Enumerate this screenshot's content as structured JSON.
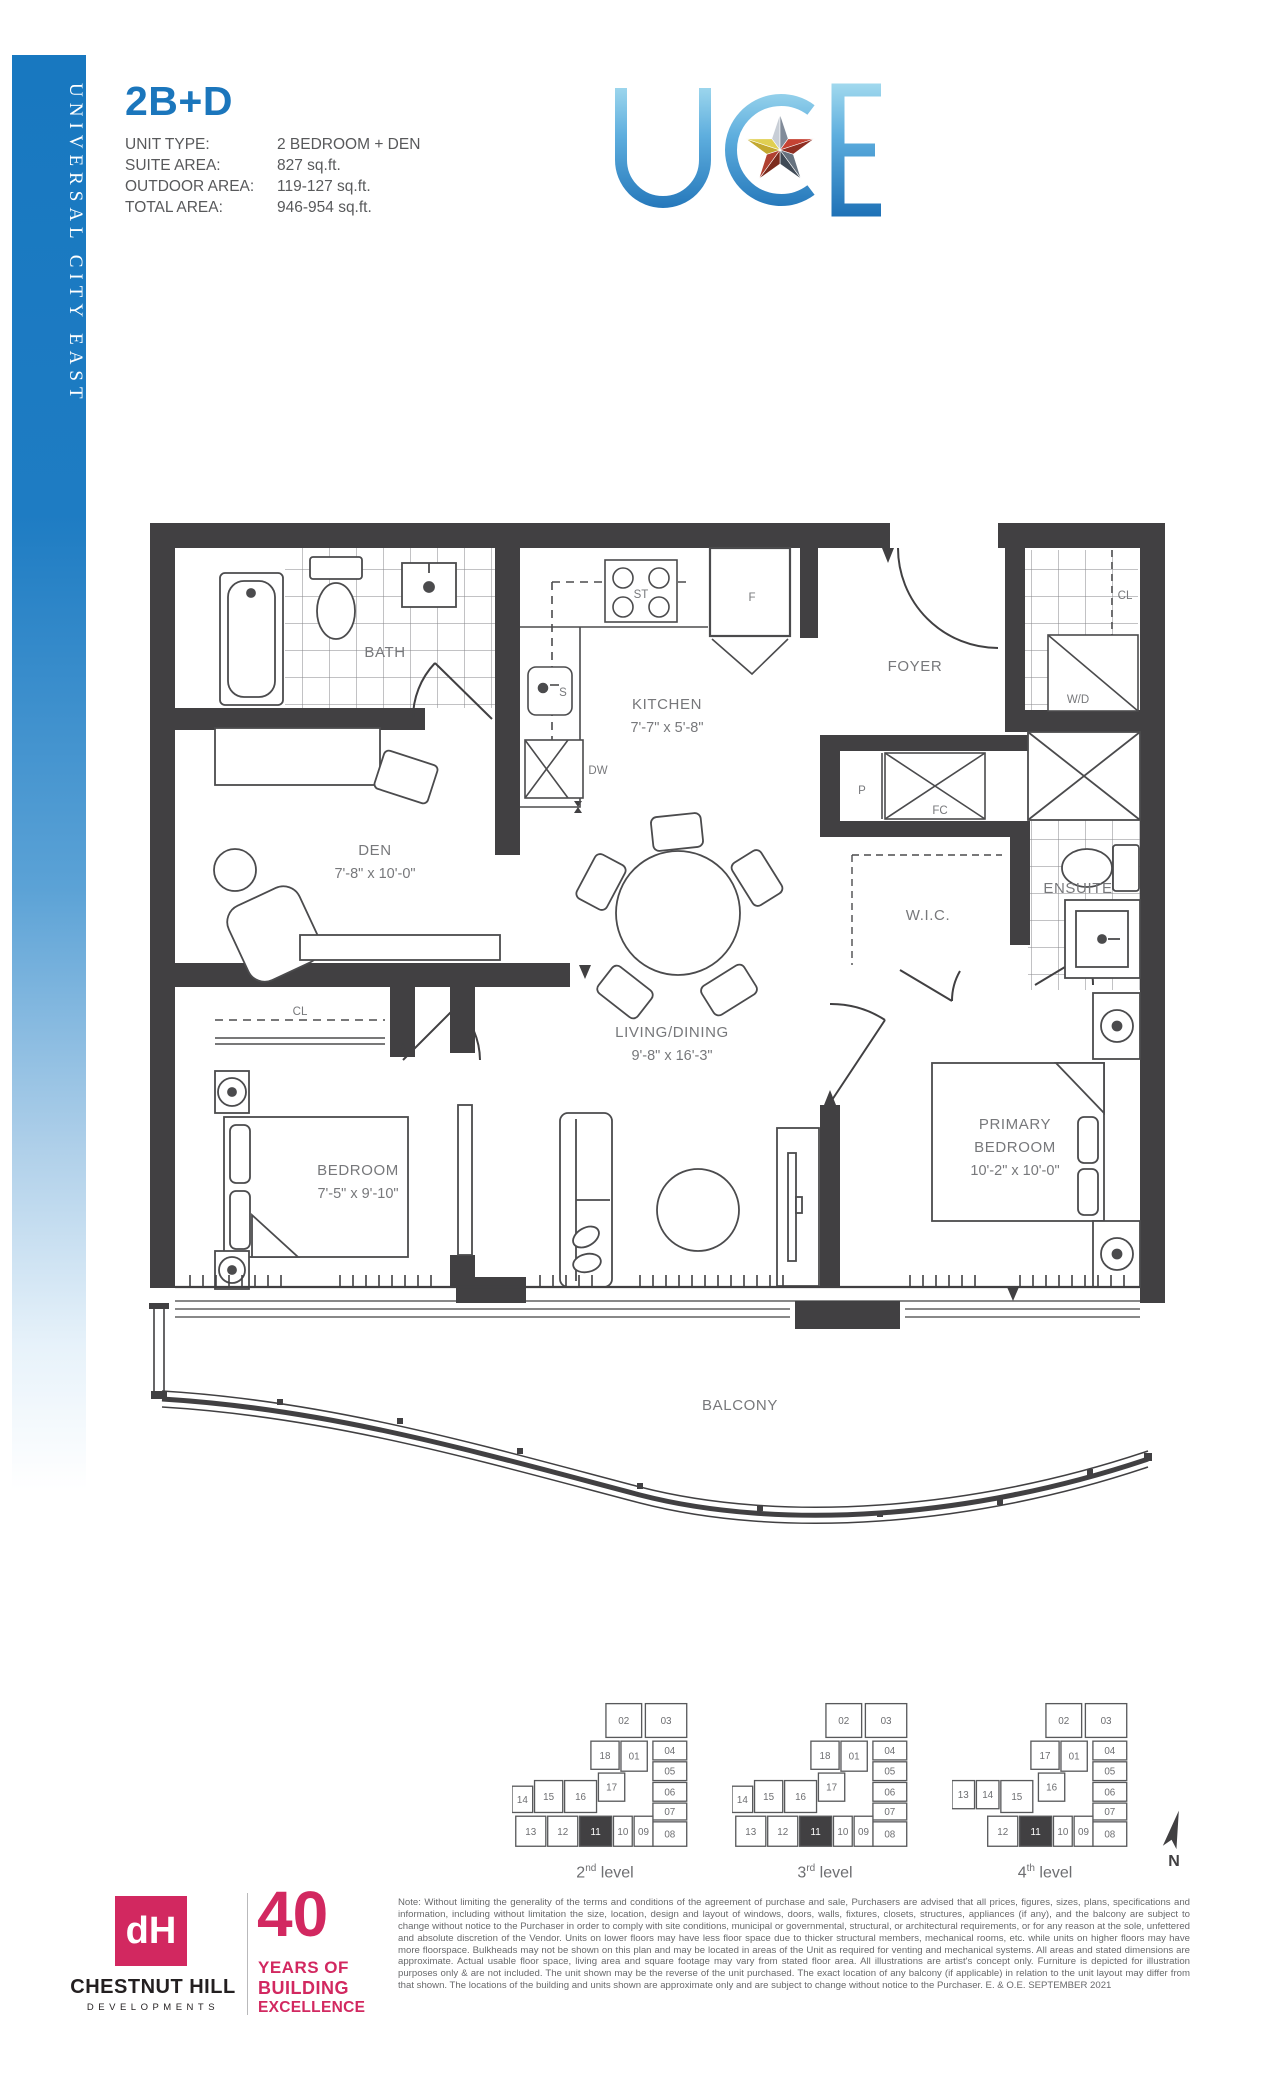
{
  "page_title": "2B+D Floor Plan",
  "sidebar": {
    "text": "UNIVERSAL CITY EAST"
  },
  "header": {
    "plan_code": "2B+D",
    "specs": [
      {
        "label": "UNIT TYPE:",
        "value": "2 BEDROOM + DEN"
      },
      {
        "label": "SUITE AREA:",
        "value": "827 sq.ft."
      },
      {
        "label": "OUTDOOR AREA:",
        "value": "119-127 sq.ft."
      },
      {
        "label": "TOTAL AREA:",
        "value": "946-954 sq.ft."
      }
    ]
  },
  "logo": {
    "name": "UCE",
    "blue_top": "#a6dcef",
    "blue_bottom": "#1c6fb5"
  },
  "colors": {
    "accent_blue": "#1b76bc",
    "brand_pink": "#d22860",
    "wall": "#414042",
    "label_gray": "#77787b"
  },
  "floorplan": {
    "bath": "BATH",
    "kitchen": "KITCHEN",
    "kitchen_dims": "7'-7\" x 5'-8\"",
    "foyer": "FOYER",
    "den": "DEN",
    "den_dims": "7'-8\" x 10'-0\"",
    "wic": "W.I.C.",
    "ensuite": "ENSUITE",
    "living": "LIVING/DINING",
    "living_dims": "9'-8\" x 16'-3\"",
    "bedroom": "BEDROOM",
    "bedroom_dims": "7'-5\" x 9'-10\"",
    "primary1": "PRIMARY",
    "primary2": "BEDROOM",
    "primary_dims": "10'-2\" x 10'-0\"",
    "balcony": "BALCONY",
    "cl_foyer": "CL",
    "cl_bedroom": "CL",
    "wd": "W/D",
    "st": "ST",
    "f": "F",
    "s": "S",
    "dw": "DW",
    "p": "P",
    "fc": "FC"
  },
  "keyplans": {
    "levels": [
      {
        "num": "2",
        "suffix": "nd",
        "word": "level",
        "cells": [
          [
            "02",
            100,
            6,
            38,
            36,
            0
          ],
          [
            "03",
            142,
            6,
            44,
            36,
            0
          ],
          [
            "04",
            150,
            46,
            36,
            20,
            0
          ],
          [
            "05",
            150,
            68,
            36,
            20,
            0
          ],
          [
            "06",
            150,
            90,
            36,
            20,
            0
          ],
          [
            "07",
            150,
            112,
            36,
            18,
            0
          ],
          [
            "08",
            150,
            132,
            36,
            26,
            0
          ],
          [
            "01",
            116,
            46,
            28,
            32,
            0
          ],
          [
            "18",
            84,
            46,
            30,
            30,
            0
          ],
          [
            "17",
            92,
            80,
            28,
            30,
            0
          ],
          [
            "16",
            56,
            88,
            34,
            34,
            0
          ],
          [
            "15",
            24,
            88,
            30,
            34,
            0
          ],
          [
            "14",
            0,
            94,
            22,
            28,
            0
          ],
          [
            "13",
            4,
            126,
            32,
            32,
            0
          ],
          [
            "12",
            38,
            126,
            32,
            32,
            0
          ],
          [
            "11",
            72,
            126,
            34,
            32,
            1
          ],
          [
            "10",
            108,
            126,
            20,
            32,
            0
          ],
          [
            "09",
            130,
            126,
            20,
            32,
            0
          ]
        ]
      },
      {
        "num": "3",
        "suffix": "rd",
        "word": "level",
        "cells": [
          [
            "02",
            100,
            6,
            38,
            36,
            0
          ],
          [
            "03",
            142,
            6,
            44,
            36,
            0
          ],
          [
            "04",
            150,
            46,
            36,
            20,
            0
          ],
          [
            "05",
            150,
            68,
            36,
            20,
            0
          ],
          [
            "06",
            150,
            90,
            36,
            20,
            0
          ],
          [
            "07",
            150,
            112,
            36,
            18,
            0
          ],
          [
            "08",
            150,
            132,
            36,
            26,
            0
          ],
          [
            "01",
            116,
            46,
            28,
            32,
            0
          ],
          [
            "18",
            84,
            46,
            30,
            30,
            0
          ],
          [
            "17",
            92,
            80,
            28,
            30,
            0
          ],
          [
            "16",
            56,
            88,
            34,
            34,
            0
          ],
          [
            "15",
            24,
            88,
            30,
            34,
            0
          ],
          [
            "14",
            0,
            94,
            22,
            28,
            0
          ],
          [
            "13",
            4,
            126,
            32,
            32,
            0
          ],
          [
            "12",
            38,
            126,
            32,
            32,
            0
          ],
          [
            "11",
            72,
            126,
            34,
            32,
            1
          ],
          [
            "10",
            108,
            126,
            20,
            32,
            0
          ],
          [
            "09",
            130,
            126,
            20,
            32,
            0
          ]
        ]
      },
      {
        "num": "4",
        "suffix": "th",
        "word": "level",
        "cells": [
          [
            "02",
            100,
            6,
            38,
            36,
            0
          ],
          [
            "03",
            142,
            6,
            44,
            36,
            0
          ],
          [
            "04",
            150,
            46,
            36,
            20,
            0
          ],
          [
            "05",
            150,
            68,
            36,
            20,
            0
          ],
          [
            "06",
            150,
            90,
            36,
            20,
            0
          ],
          [
            "07",
            150,
            112,
            36,
            18,
            0
          ],
          [
            "08",
            150,
            132,
            36,
            26,
            0
          ],
          [
            "01",
            116,
            46,
            28,
            32,
            0
          ],
          [
            "17",
            84,
            46,
            30,
            30,
            0
          ],
          [
            "16",
            92,
            80,
            28,
            30,
            0
          ],
          [
            "15",
            52,
            88,
            34,
            34,
            0
          ],
          [
            "14",
            26,
            88,
            24,
            30,
            0
          ],
          [
            "13",
            0,
            88,
            24,
            30,
            0
          ],
          [
            "12",
            38,
            126,
            32,
            32,
            0
          ],
          [
            "11",
            72,
            126,
            34,
            32,
            1
          ],
          [
            "10",
            108,
            126,
            20,
            32,
            0
          ],
          [
            "09",
            130,
            126,
            20,
            32,
            0
          ]
        ]
      }
    ]
  },
  "north": {
    "label": "N"
  },
  "footer": {
    "brand_monogram": "dH",
    "brand_name": "CHESTNUT HILL",
    "brand_sub": "DEVELOPMENTS",
    "badge_number": "40",
    "badge_line1": "YEARS OF",
    "badge_line2": "BUILDING",
    "badge_line3": "EXCELLENCE",
    "note": "Note: Without limiting the generality of the terms and conditions of the agreement of purchase and sale, Purchasers are advised that all prices, figures, sizes, plans, specifications and information, including without limitation the size, location, design and layout of windows, doors, walls, fixtures, closets, structures, appliances (if any), and the balcony are subject to change without notice to the Purchaser in order to comply with site conditions, municipal or governmental, structural, or architectural requirements, or for any reason at the sole, unfettered and absolute discretion of the Vendor. Units on lower floors may have less floor space due to thicker structural members, mechanical rooms, etc. while units on higher floors may have more floorspace. Bulkheads may not be shown on this plan and may be located in areas of the Unit as required for venting and mechanical systems. All areas and stated dimensions are approximate. Actual usable floor space, living area and square footage may vary from stated floor area. All illustrations are artist's concept only. Furniture is depicted for illustration purposes only & are not included. The unit shown may be the reverse of the unit purchased. The exact location of any balcony (if applicable) in relation to the unit layout may differ from that shown. The locations of the building and units shown are approximate only and are subject to change without notice to the Purchaser. E. & O.E. SEPTEMBER 2021"
  }
}
